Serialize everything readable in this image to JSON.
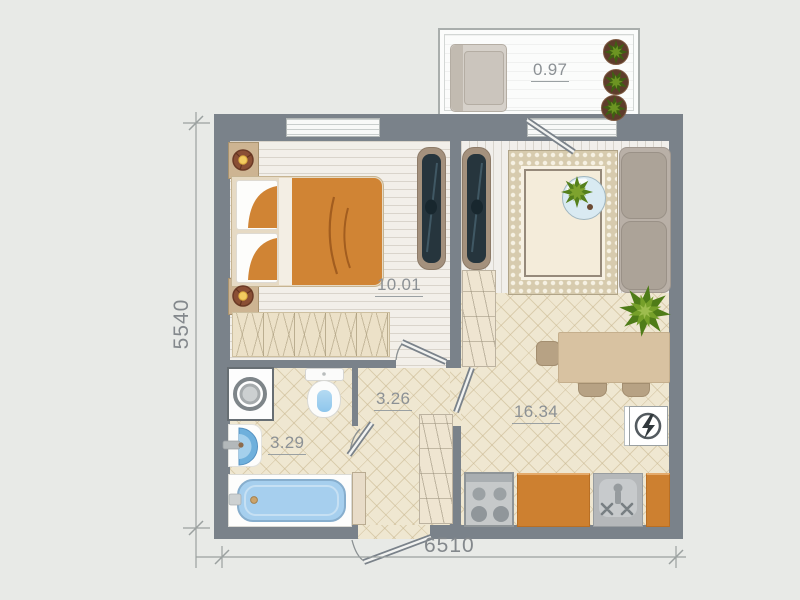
{
  "plan_type": "apartment-floor-plan",
  "room_labels": {
    "balcony": "0.97",
    "bedroom": "10.01",
    "hallway": "3.26",
    "bathroom": "3.29",
    "living_kitchen": "16.34"
  },
  "dimensions": {
    "overall_width": "6510",
    "overall_height": "5540"
  },
  "colors": {
    "canvas_background": "#e8eae7",
    "wall": "#7a828a",
    "tile_floor": "#efe7d1",
    "plank_floor": "#f2efe9",
    "counter_orange": "#cd8030",
    "blanket_orange": "#d08434",
    "water_blue": "#a6cfee",
    "plant_green": "#55801c",
    "area_label_text": "#8c9195",
    "dimension_text": "#83888c"
  },
  "icons": {
    "bed": "rect-shape",
    "wardrobe-mirror": "rounded-rect-shape",
    "washing-machine": "concentric-circles",
    "toilet": "tank-and-bowl-shape",
    "bathroom-sink": "half-disc-shape",
    "bathtub": "rounded-rect-shape",
    "stove": "four-burner-circles",
    "kitchen-sink": "basin-with-x-taps",
    "electric-panel": "circle-with-lightning-bolt",
    "plant": "star-burst-shape",
    "sofa": "cushion-rects",
    "armchair": "cushion-rect",
    "dining-table": "rect-shape",
    "door-leaf": "diagonal-double-line",
    "dimension-tick": "slash-mark"
  }
}
